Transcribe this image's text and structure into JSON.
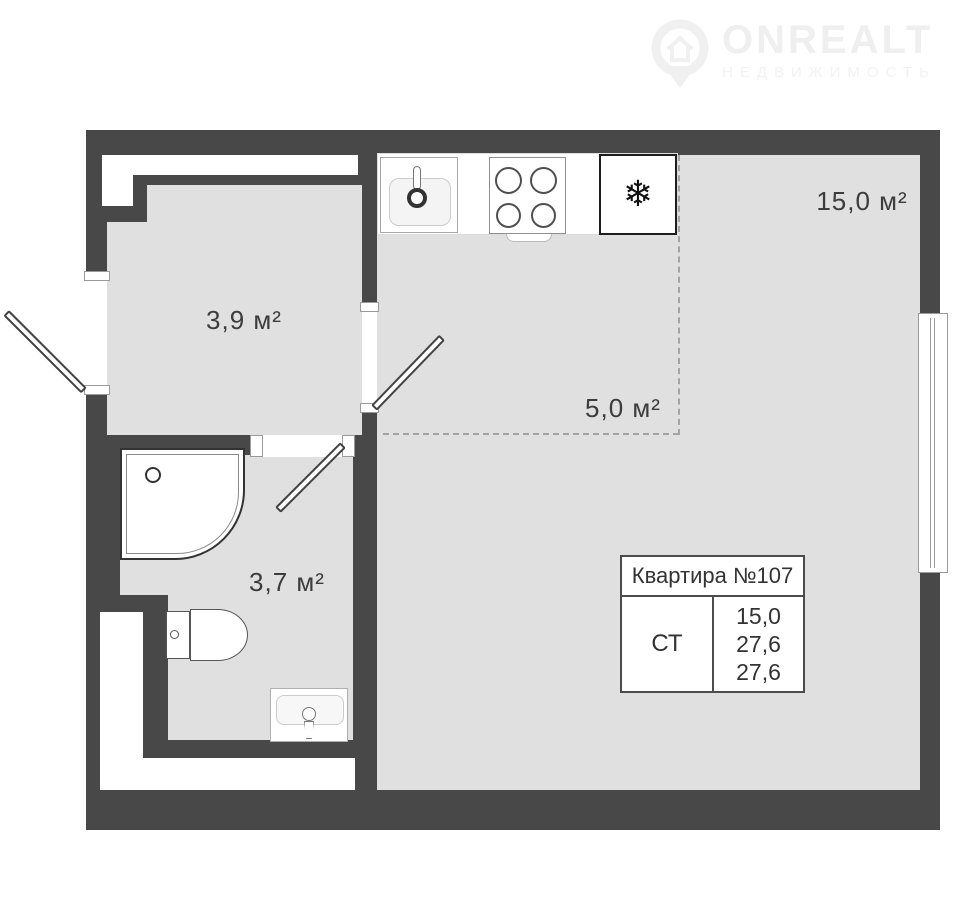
{
  "watermark": {
    "brand": "ONREALT",
    "subtitle": "НЕДВИЖИМОСТЬ"
  },
  "rooms": {
    "hallway": {
      "label": "3,9 м²"
    },
    "kitchen_zone": {
      "label": "5,0 м²"
    },
    "living": {
      "label": "15,0 м²"
    },
    "bathroom": {
      "label": "3,7 м²"
    }
  },
  "info_table": {
    "title": "Квартира №107",
    "unit_type": "СТ",
    "areas": [
      "15,0",
      "27,6",
      "27,6"
    ]
  },
  "icons": {
    "fridge_snowflake": "❄"
  },
  "colors": {
    "wall": "#484848",
    "floor": "#e0e0e0",
    "dashed_line": "#a3a3a3",
    "label_text": "#3c3c3c"
  }
}
